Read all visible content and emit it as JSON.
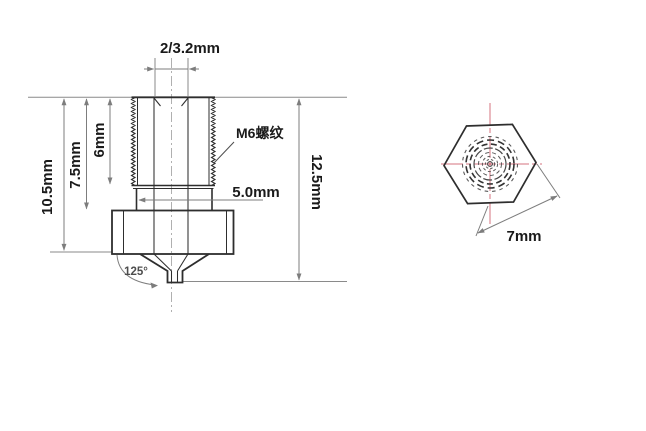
{
  "figure": {
    "type": "technical-drawing",
    "subject": "nozzle",
    "side_view": {
      "labels": {
        "bore_diameter": "2/3.2mm",
        "thread": "M6螺纹",
        "shank_diameter": "5.0mm",
        "thread_length": "6mm",
        "shank_length": "7.5mm",
        "body_length": "10.5mm",
        "overall_length": "12.5mm",
        "tip_angle": "125°"
      }
    },
    "top_view": {
      "labels": {
        "hex_across_flats": "7mm"
      }
    },
    "colors": {
      "outline": "#2e2e2e",
      "dimension": "#7d7d7d",
      "centerline_gray": "#a8a8a8",
      "centerline_pink": "#d4737f",
      "text": "#1a1a1a",
      "background": "#ffffff"
    }
  }
}
